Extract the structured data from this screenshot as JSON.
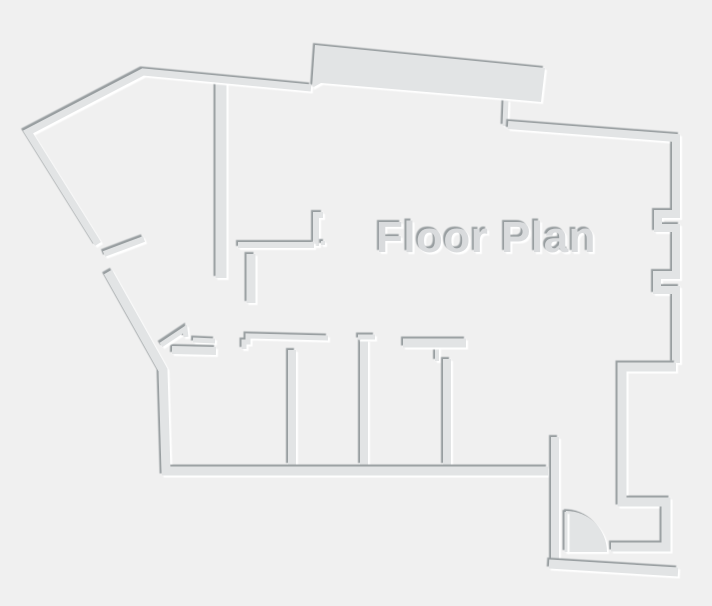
{
  "title": "Floor Plan",
  "canvas": {
    "width": 712,
    "height": 606
  },
  "colors": {
    "background": "#f0f0f0",
    "wall": "#e2e4e5",
    "shadow_dark": "#989ea0",
    "highlight": "#ffffff",
    "text": "#d9dbdd"
  },
  "text_label": {
    "content": "Floor Plan",
    "x": 486,
    "y": 252,
    "font_size": 44
  },
  "floorplan": {
    "shapes": [
      {
        "name": "band-door-post",
        "type": "stroke",
        "d": "M506,100 L505,126",
        "width": 5
      },
      {
        "name": "top-band-wall",
        "type": "fill",
        "d": "M315,45 L545,68 L541,102 L508,99 L321,83 L312,88 Z"
      },
      {
        "name": "hall-wall-vertical",
        "type": "stroke",
        "d": "M221,82 L221,278",
        "width": 11
      },
      {
        "name": "outer-wall-top-left",
        "type": "stroke",
        "d": "M98,244 L28,132 L143,72 L311,88",
        "width": 7
      },
      {
        "name": "diagonal-door-stub",
        "type": "stroke",
        "d": "M104,254 L144,239",
        "width": 6
      },
      {
        "name": "cluster-riser-wall",
        "type": "stroke",
        "d": "M323,215 L316,215 L316,246",
        "width": 6
      },
      {
        "name": "cluster-horizontal-wall",
        "type": "stroke",
        "d": "M238,245 L314,245",
        "width": 6
      },
      {
        "name": "hinge-dot",
        "type": "fill",
        "d": "M321,241 l4,0 l0,4 l-4,0 Z"
      },
      {
        "name": "cluster-lower-wall",
        "type": "stroke",
        "d": "M251,254 L251,303",
        "width": 9
      },
      {
        "name": "right-outer-wall",
        "type": "stroke",
        "d": "M508,125 L676,138 L676,214 L658,214 L658,228 L676,228 L676,275 L657,275 L657,290 L676,290 L676,363",
        "width": 8
      },
      {
        "name": "right-hook-wall",
        "type": "stroke",
        "d": "M676,367 L622,367 L622,502 L666,502 L666,547 L611,547",
        "width": 9
      },
      {
        "name": "room-divider-1",
        "type": "stroke",
        "d": "M292,350 L292,465",
        "width": 8
      },
      {
        "name": "room-divider-2",
        "type": "stroke",
        "d": "M364,340 L364,465",
        "width": 8
      },
      {
        "name": "room-divider-2-header",
        "type": "stroke",
        "d": "M358,337 L375,337",
        "width": 5
      },
      {
        "name": "room-divider-3-tick",
        "type": "stroke",
        "d": "M437,340 L437,361",
        "width": 4
      },
      {
        "name": "room-divider-3",
        "type": "stroke",
        "d": "M447,359 L447,465",
        "width": 8
      },
      {
        "name": "rooms-top-wall-right",
        "type": "stroke",
        "d": "M403,343 L466,343",
        "width": 9
      },
      {
        "name": "rooms-top-wall-middle",
        "type": "stroke",
        "d": "M244,349 L244,342 L248,342 L248,336 L328,338",
        "width": 5
      },
      {
        "name": "rooms-top-stub",
        "type": "stroke",
        "d": "M193,340 L215,341",
        "width": 5
      },
      {
        "name": "room1-top-wall",
        "type": "stroke",
        "d": "M172,350 L216,351",
        "width": 8
      },
      {
        "name": "room1-angled-wall",
        "type": "stroke",
        "d": "M161,345 L185,329 L186,337",
        "width": 5
      },
      {
        "name": "outer-wall-left-bottom",
        "type": "stroke",
        "d": "M108,272 L163,370 L166,471 L548,471",
        "width": 9
      },
      {
        "name": "door-jamb-wall",
        "type": "stroke",
        "d": "M555,437 L555,565",
        "width": 8
      },
      {
        "name": "door-swing-arc",
        "type": "fill",
        "d": "M566,552 L566,511 A41,41 0 0 1 607,552 Z"
      },
      {
        "name": "door-leaf",
        "type": "stroke",
        "d": "M566,512 L566,552",
        "width": 3
      },
      {
        "name": "bottom-outer-wall",
        "type": "stroke",
        "d": "M549,564 L678,572",
        "width": 9
      }
    ]
  }
}
